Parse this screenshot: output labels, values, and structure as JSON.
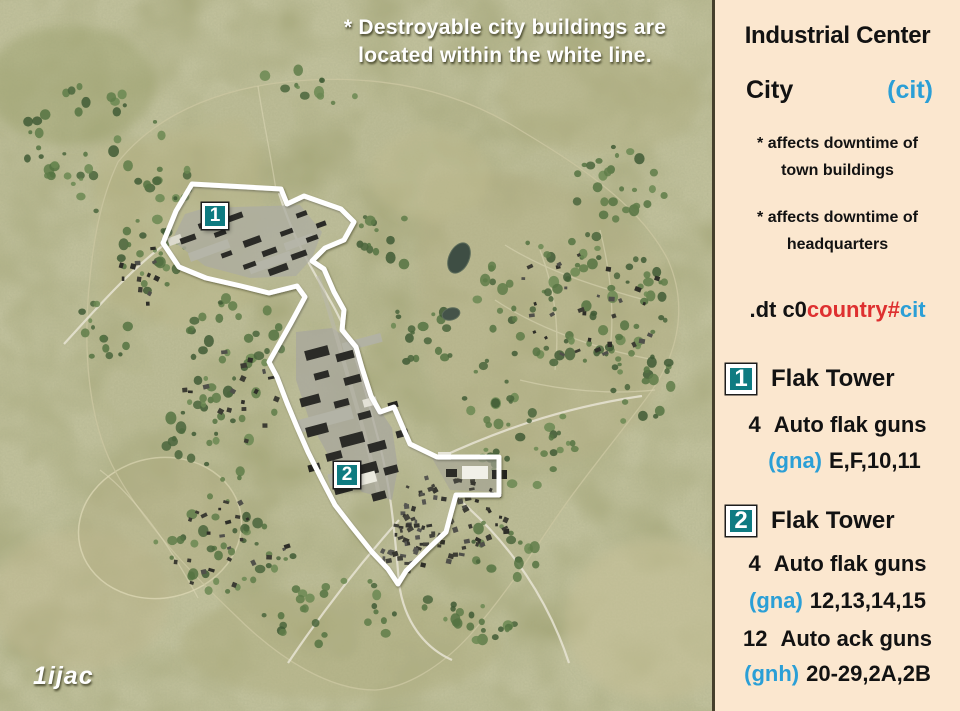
{
  "colors": {
    "teal": "#0f7b81",
    "azure": "#2b9fd6",
    "red": "#de3030",
    "panel-bg": "#fbe7cf"
  },
  "map": {
    "note_line1": "* Destroyable city buildings are",
    "note_line2": "located within the white line.",
    "credit": "1ijac",
    "markers": [
      {
        "number": "1"
      },
      {
        "number": "2"
      }
    ]
  },
  "panel": {
    "title": "Industrial Center",
    "subtitle": {
      "name": "City",
      "code": "(cit)"
    },
    "notes": [
      {
        "line1": "* affects downtime of",
        "line2": "town buildings"
      },
      {
        "line1": "* affects downtime of",
        "line2": "headquarters"
      }
    ],
    "command": {
      "prefix": ".dt c0",
      "middle": "country#",
      "suffix": "cit"
    },
    "sections": [
      {
        "marker": "1",
        "title": "Flak Tower",
        "guns": [
          {
            "count": "4",
            "label": "Auto flak guns",
            "code": "(gna)",
            "ids": "E,F,10,11"
          }
        ]
      },
      {
        "marker": "2",
        "title": "Flak Tower",
        "guns": [
          {
            "count": "4",
            "label": "Auto flak guns",
            "code": "(gna)",
            "ids": "12,13,14,15"
          },
          {
            "count": "12",
            "label": "Auto ack guns",
            "code": "(gnh)",
            "ids": "20-29,2A,2B"
          }
        ]
      }
    ]
  }
}
